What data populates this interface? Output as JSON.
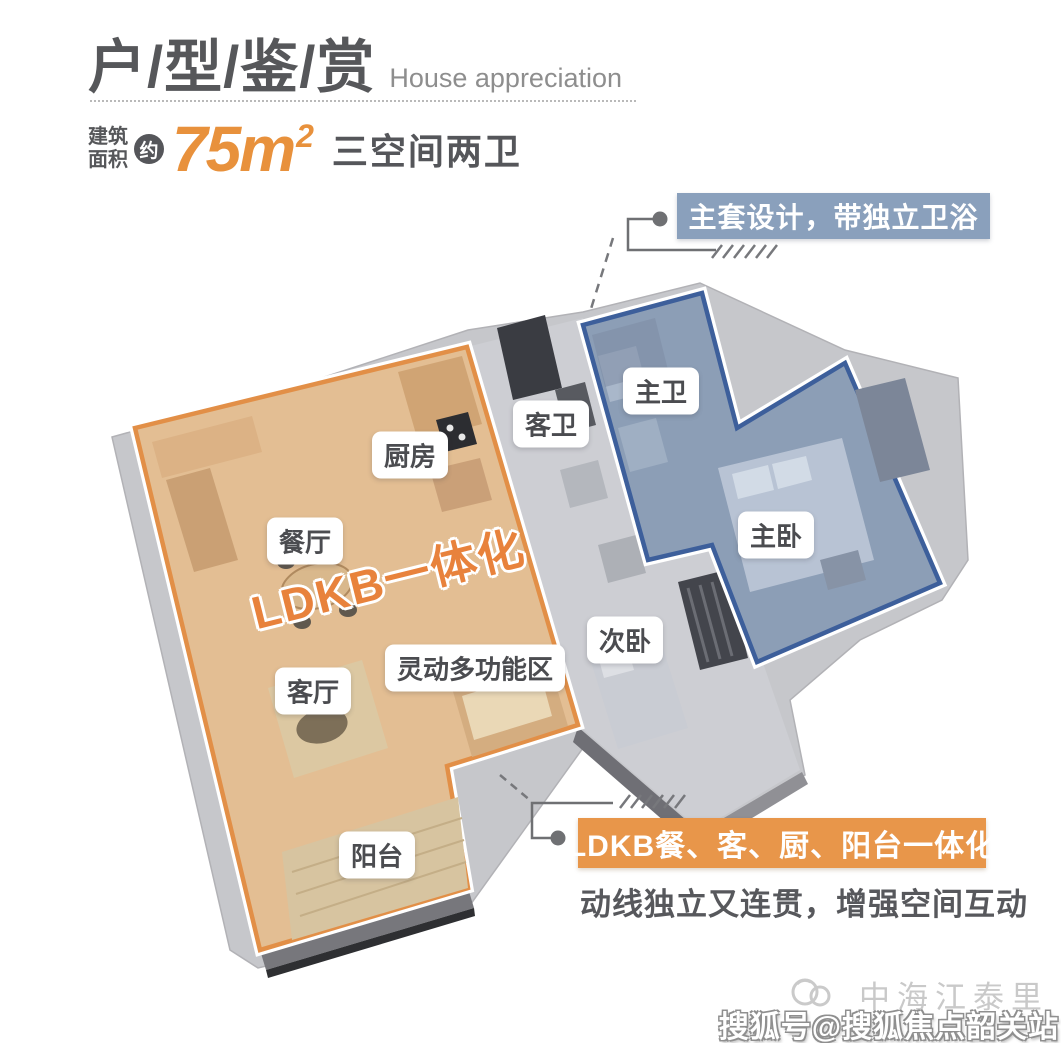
{
  "header": {
    "title_cn": "户/型/鉴/赏",
    "title_en": "House appreciation",
    "area_label_top": "建筑",
    "area_label_bottom": "面积",
    "approx": "约",
    "area_number": "75m",
    "area_sup": "2",
    "spec": "三空间两卫"
  },
  "callouts": {
    "master_suite": "主套设计，带独立卫浴",
    "ldkb": "LDKB餐、客、厨、阳台一体化",
    "ldkb_sub": "动线独立又连贯，增强空间互动"
  },
  "floorplan": {
    "zone_text": "LDKB一体化",
    "rooms": [
      {
        "id": "kitchen",
        "label": "厨房"
      },
      {
        "id": "dining",
        "label": "餐厅"
      },
      {
        "id": "guest-bath",
        "label": "客卫"
      },
      {
        "id": "master-bath",
        "label": "主卫"
      },
      {
        "id": "master-bed",
        "label": "主卧"
      },
      {
        "id": "second-bed",
        "label": "次卧"
      },
      {
        "id": "living",
        "label": "客厅"
      },
      {
        "id": "flex-zone",
        "label": "灵动多功能区"
      },
      {
        "id": "balcony",
        "label": "阳台"
      }
    ]
  },
  "watermark": {
    "brand": "中海江泰里",
    "account": "搜狐号@搜狐焦点韶关站"
  },
  "colors": {
    "accent_orange": "#E8913C",
    "zone_orange_fill": "#E3BE93",
    "zone_orange_border": "#E28F47",
    "zone_blue_fill": "#8C9EB6",
    "zone_blue_border": "#3D5F9B",
    "callout_blue_bg": "#8AA0BC",
    "callout_orange_bg": "#E8964A",
    "title_gray": "#56575A"
  }
}
